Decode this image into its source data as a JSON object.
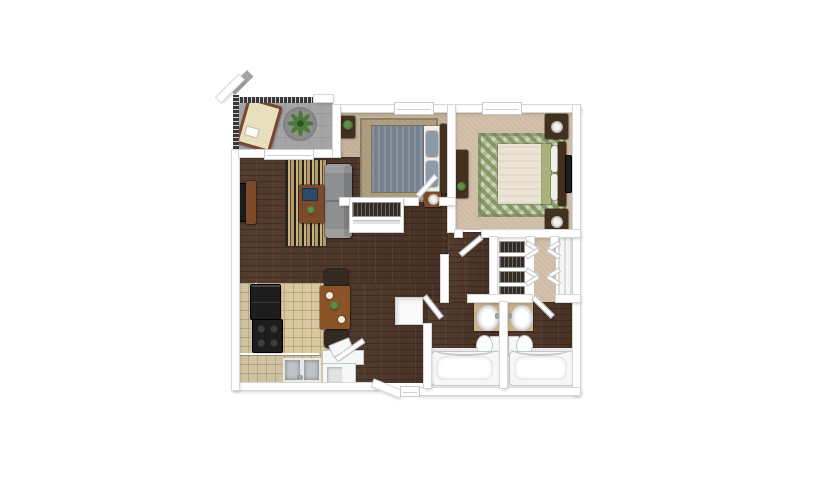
{
  "canvas": {
    "width": 825,
    "height": 500,
    "background_color": "#ffffff"
  },
  "floorplan": {
    "type": "3d-rendered-apartment-floor-plan",
    "rooms": [
      {
        "name": "balcony",
        "floor_key": "balcony_floor",
        "furniture": [
          "chaise-lounge",
          "round-outdoor-rug",
          "potted-plant",
          "railing"
        ]
      },
      {
        "name": "bedroom-1",
        "floor_key": "carpet_bedroom1",
        "furniture": [
          "bed",
          "area-rug",
          "nightstand",
          "lamp",
          "plant-stand",
          "sliding-door-closet",
          "window"
        ]
      },
      {
        "name": "bedroom-2",
        "floor_key": "carpet_bedroom2",
        "furniture": [
          "bed",
          "diamond-area-rug",
          "nightstand",
          "nightstand",
          "lamp",
          "lamp",
          "dresser",
          "wall-tv",
          "window"
        ]
      },
      {
        "name": "living-room",
        "floor_key": "wood_floor",
        "furniture": [
          "striped-area-rug",
          "sofa",
          "coffee-table",
          "laptop",
          "tv-console",
          "tv",
          "balcony-sliding-door"
        ]
      },
      {
        "name": "dining-area",
        "floor_key": "wood_floor",
        "furniture": [
          "dining-table",
          "dining-chair",
          "dining-chair"
        ]
      },
      {
        "name": "kitchen",
        "floor_key": "kitchen_tile",
        "furniture": [
          "l-shaped-counter",
          "refrigerator",
          "stove",
          "double-sink"
        ]
      },
      {
        "name": "entry",
        "floor_key": "wood_floor",
        "furniture": [
          "front-door",
          "washer-dryer-counter"
        ]
      },
      {
        "name": "hallway",
        "floor_key": "wood_floor",
        "furniture": [
          "linen-closet"
        ]
      },
      {
        "name": "walk-in-closet-1",
        "floor_key": "wall",
        "furniture": [
          "hanging-clothes",
          "bifold-doors"
        ]
      },
      {
        "name": "walk-in-closet-2",
        "floor_key": "wall",
        "furniture": [
          "shelving",
          "bifold-doors"
        ]
      },
      {
        "name": "dressing-corridor",
        "floor_key": "carpet_bedroom2",
        "furniture": []
      },
      {
        "name": "bathroom-1",
        "floor_key": "bath_tile",
        "furniture": [
          "vanity-sink",
          "toilet",
          "bathtub"
        ]
      },
      {
        "name": "bathroom-2",
        "floor_key": "bath_tile",
        "furniture": [
          "vanity-sink",
          "toilet",
          "bathtub"
        ]
      }
    ]
  },
  "palette": {
    "background": "#ffffff",
    "wall": "#ffffff",
    "wall_edge": "#d6d6d6",
    "wood_floor": "#4d3527",
    "carpet_bedroom1": "#c6b49c",
    "carpet_bedroom2": "#d4c1ab",
    "kitchen_tile": "#d9c89f",
    "counter_tile": "#cec2a2",
    "bath_tile": "#e8eaeb",
    "balcony_floor": "#a5a5a7",
    "balcony_rug": "#8e8e90",
    "railing": "#39393b",
    "rug_bed1": "#b09f82",
    "rug_bed2": "#ccd2b8",
    "rug_living_base": "#b59a6d",
    "sofa_gray": "#8e8f90",
    "sofa_back": "#7b7c7d",
    "bed1_duvet": "#75818e",
    "bed1_pillow": "#8c9aa9",
    "mattress_white": "#f0efe9",
    "bed2_duvet": "#ebe4d4",
    "bed2_accent": "#a9b27c",
    "headboard_dark": "#43301f",
    "furniture_wood_mid": "#7c4a28",
    "furniture_wood_table": "#8a5428",
    "chair_dark": "#332a22",
    "appliance_black": "#1d1d1d",
    "fixture_white": "#f6f7f7",
    "vanity_counter": "#c9b28d",
    "sink_gray": "#c0c3c5",
    "laptop_blue": "#2e4a66",
    "plant_green": "#4c7a38",
    "clothes_dark": "#332c26",
    "closet_shelf": "#ededed",
    "linen_closet": "#fafafa"
  }
}
